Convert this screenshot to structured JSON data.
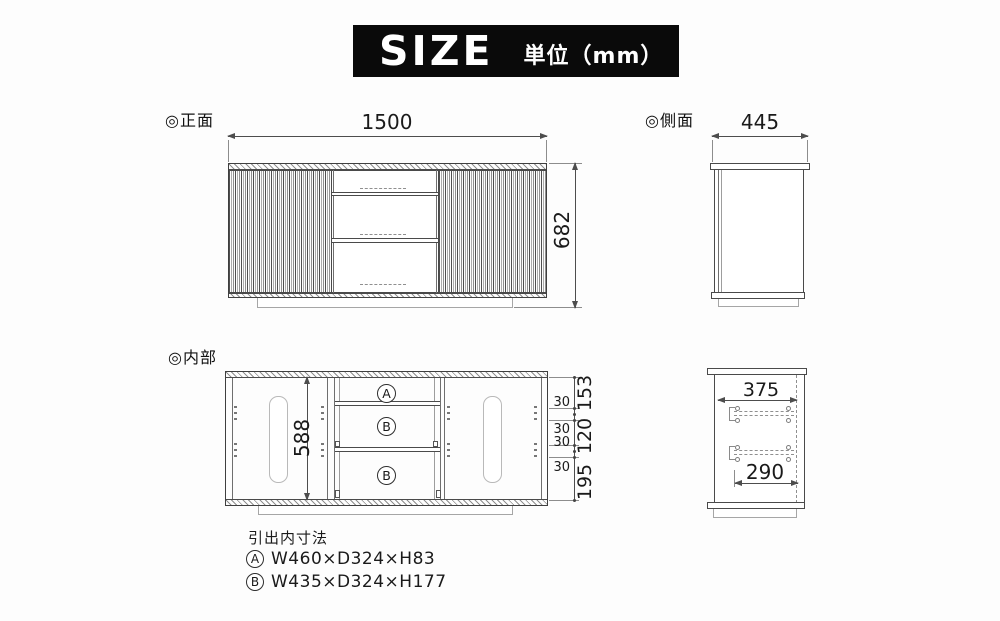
{
  "title": {
    "main": "SIZE",
    "unit": "単位（mm）"
  },
  "views": {
    "front": {
      "label": "◎正面",
      "width_mm": "1500",
      "height_mm": "682"
    },
    "side": {
      "label": "◎側面",
      "depth_mm": "445"
    },
    "internal": {
      "label": "◎内部",
      "inner_height_mm": "588",
      "drawer_labels": [
        "A",
        "B",
        "B"
      ],
      "small_dims": [
        "30",
        "30",
        "30",
        "30"
      ],
      "large_dims": [
        "153",
        "120",
        "195"
      ]
    },
    "side_internal": {
      "upper_depth_mm": "375",
      "lower_depth_mm": "290"
    }
  },
  "legend": {
    "heading": "引出内寸法",
    "rows": [
      {
        "tag": "A",
        "dims": "W460×D324×H83"
      },
      {
        "tag": "B",
        "dims": "W435×D324×H177"
      }
    ]
  },
  "colors": {
    "line": "#4a4a4a",
    "dim": "#4d4d4d",
    "title_bg": "#0a0a0a",
    "title_fg": "#ffffff",
    "light": "#a6a6a6"
  }
}
